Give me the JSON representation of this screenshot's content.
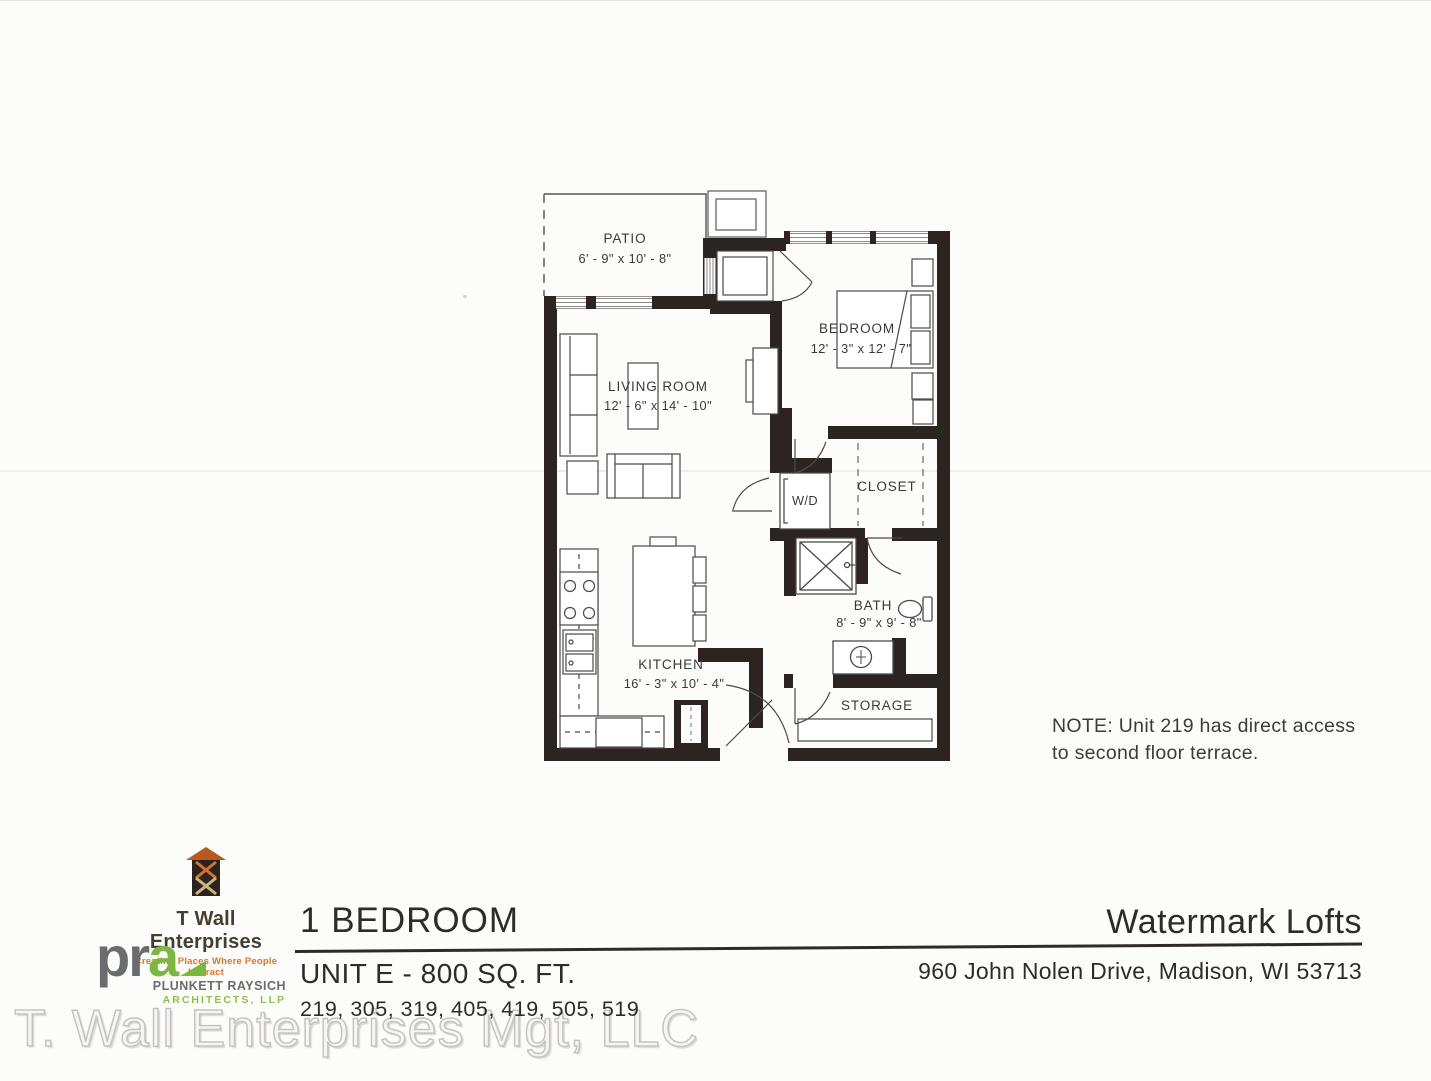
{
  "plan": {
    "patio_name": "PATIO",
    "patio_dims": "6' - 9\" x 10' - 8\"",
    "living_name": "LIVING ROOM",
    "living_dims": "12' - 6\" x 14' - 10\"",
    "bedroom_name": "BEDROOM",
    "bedroom_dims": "12' - 3\" x 12' - 7\"",
    "closet_name": "CLOSET",
    "wd_name": "W/D",
    "bath_name": "BATH",
    "bath_dims": "8' - 9\" x 9' - 8\"",
    "kitchen_name": "KITCHEN",
    "kitchen_dims": "16' - 3\" x 10' - 4\"",
    "storage_name": "STORAGE",
    "note_line1": "NOTE: Unit 219 has direct access",
    "note_line2": "to second floor terrace."
  },
  "footer": {
    "twall_name": "T Wall Enterprises",
    "twall_tagline": "Creating Places Where People Interact",
    "pra_pr": "pr",
    "pra_a": "a",
    "pra_firm1": "PLUNKETT RAYSICH",
    "pra_firm2": "ARCHITECTS, LLP",
    "unit_type": "1 BEDROOM",
    "unit_label": "UNIT E - 800 SQ. FT.",
    "unit_numbers": "219, 305, 319, 405, 419, 505, 519",
    "property_name": "Watermark Lofts",
    "property_address": "960 John Nolen Drive, Madison, WI 53713"
  },
  "watermark": "T. Wall Enterprises Mgt, LLC",
  "colors": {
    "wall": "#2b2421",
    "accent_orange": "#d8762a",
    "accent_green": "#7cb643",
    "logo_gray": "#6a6c6e"
  }
}
